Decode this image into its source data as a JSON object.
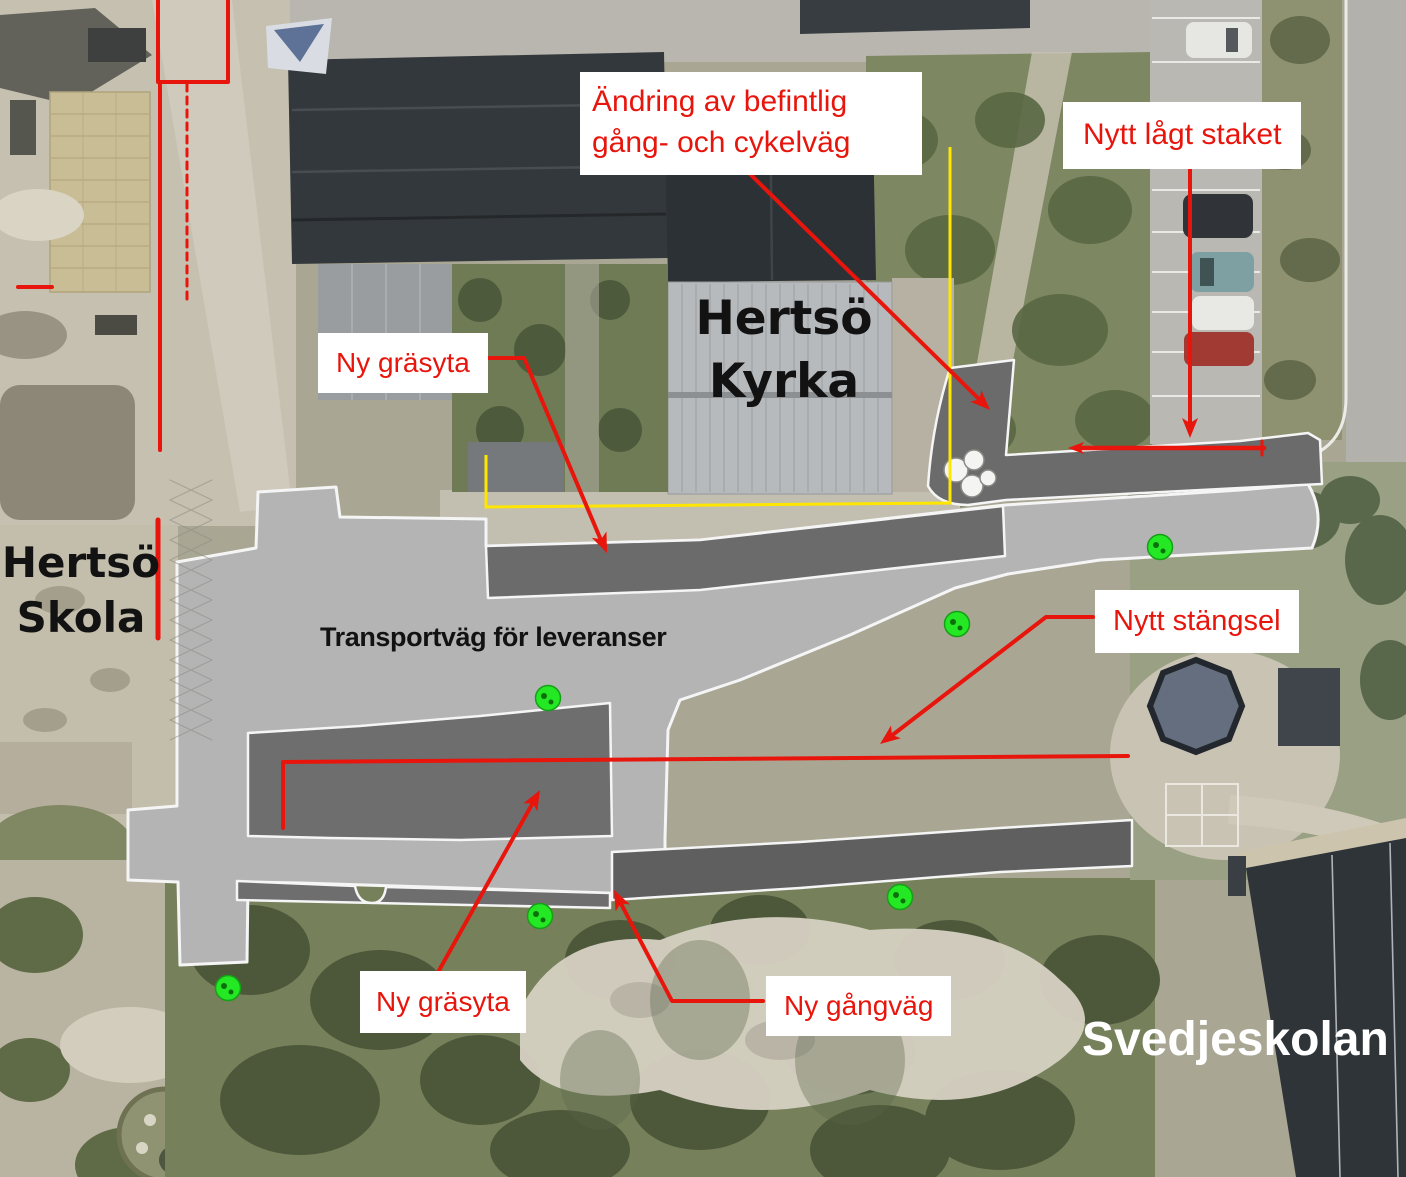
{
  "annotations": {
    "andring": {
      "text": "Ändring av befintlig\ngång- och cykelväg"
    },
    "staket": {
      "text": "Nytt lågt staket"
    },
    "grasyta_upper": {
      "text": "Ny gräsyta"
    },
    "stangsel": {
      "text": "Nytt stängsel"
    },
    "grasyta_lower": {
      "text": "Ny gräsyta"
    },
    "gangvag": {
      "text": "Ny gångväg"
    }
  },
  "places": {
    "kyrka": {
      "text": "Hertsö\nKyrka"
    },
    "skola": {
      "text": "Hertsö\nSkola"
    },
    "svedjeskolan": {
      "text": "Svedjeskolan"
    },
    "transportvag": {
      "text": "Transportväg för leveranser"
    }
  },
  "colors": {
    "annotation_red": "#e8150c",
    "annotation_box_bg": "#ffffff",
    "boundary_yellow": "#ffe600",
    "tree_marker_green": "#25e825",
    "plan_light_gray": "#b4b4b4",
    "plan_dark_gray": "#6b6b6b",
    "plan_outline_white": "#f5f5f5",
    "place_label_black": "#121212",
    "place_label_white": "#ffffff"
  },
  "plan_features": {
    "tree_markers": [
      {
        "x": 1160,
        "y": 547
      },
      {
        "x": 957,
        "y": 624
      },
      {
        "x": 548,
        "y": 698
      },
      {
        "x": 540,
        "y": 916
      },
      {
        "x": 900,
        "y": 897
      },
      {
        "x": 228,
        "y": 988
      }
    ],
    "tree_marker_count": 6
  }
}
